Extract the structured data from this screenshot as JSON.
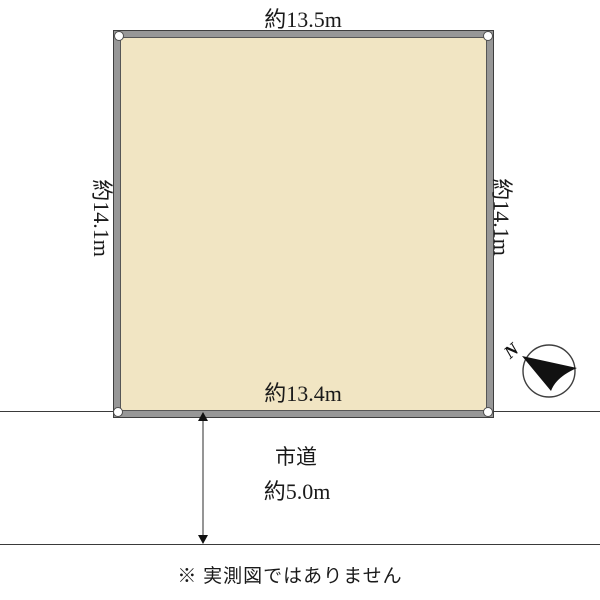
{
  "diagram": {
    "type": "land-plot-layout",
    "plot": {
      "fill_color": "#f1e5c3",
      "border_color": "#979797",
      "dim_top": "約13.5m",
      "dim_bottom": "約13.4m",
      "dim_left": "約14.1m",
      "dim_right": "約14.1m"
    },
    "road": {
      "name": "市道",
      "width_label": "約5.0m"
    },
    "compass": {
      "label": "N"
    },
    "note": "※ 実測図ではありません"
  }
}
